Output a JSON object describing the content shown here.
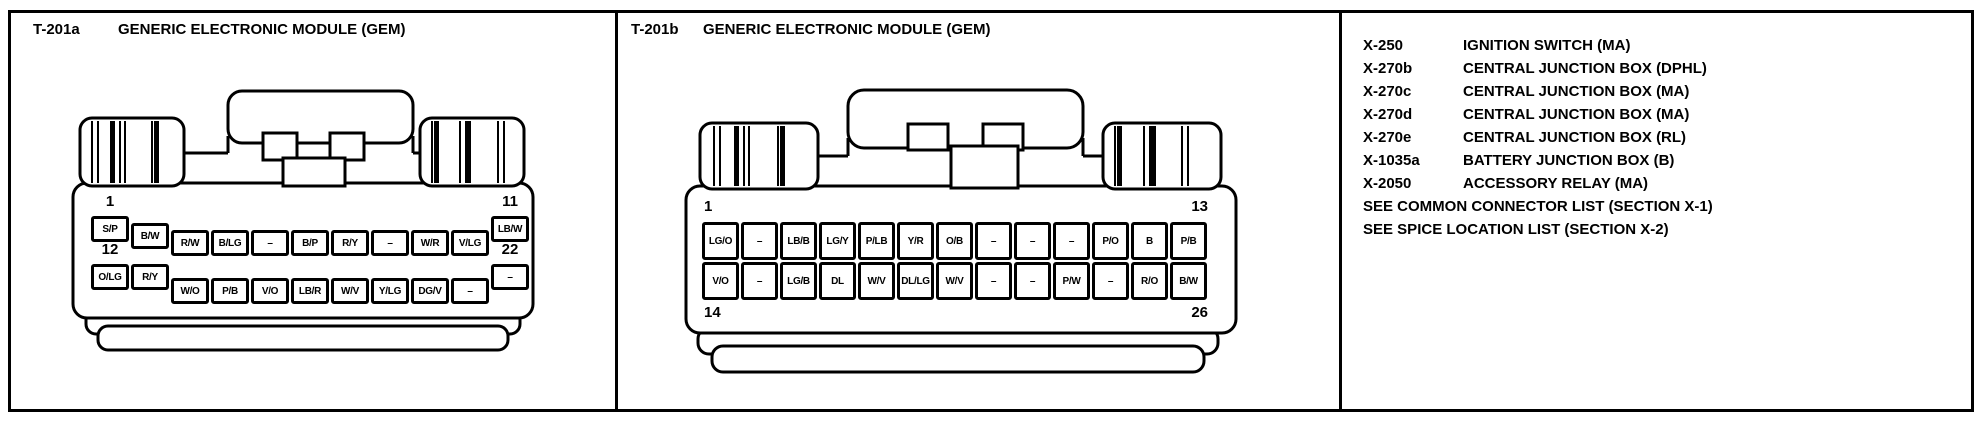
{
  "colors": {
    "ink": "#000000",
    "paper": "#ffffff"
  },
  "panels": {
    "t201a": {
      "code": "T-201a",
      "title": "GENERIC ELECTRONIC MODULE (GEM)",
      "connector": {
        "row1": {
          "start_pin": "1",
          "end_pin": "11",
          "cells": [
            "S/P",
            "B/W",
            "R/W",
            "B/LG",
            "–",
            "B/P",
            "R/Y",
            "–",
            "W/R",
            "V/LG",
            "LB/W"
          ]
        },
        "row2": {
          "start_pin": "12",
          "end_pin": "22",
          "cells": [
            "O/LG",
            "R/Y",
            "W/O",
            "P/B",
            "V/O",
            "LB/R",
            "W/V",
            "Y/LG",
            "DG/V",
            "–",
            "–"
          ]
        }
      }
    },
    "t201b": {
      "code": "T-201b",
      "title": "GENERIC ELECTRONIC MODULE (GEM)",
      "connector": {
        "row1": {
          "start_pin": "1",
          "end_pin": "13",
          "cells": [
            "LG/O",
            "–",
            "LB/B",
            "LG/Y",
            "P/LB",
            "Y/R",
            "O/B",
            "–",
            "–",
            "–",
            "P/O",
            "B",
            "P/B"
          ]
        },
        "row2": {
          "start_pin": "14",
          "end_pin": "26",
          "cells": [
            "V/O",
            "–",
            "LG/B",
            "DL",
            "W/V",
            "DL/LG",
            "W/V",
            "–",
            "–",
            "P/W",
            "–",
            "R/O",
            "B/W"
          ]
        }
      }
    },
    "legend": {
      "entries": [
        {
          "code": "X-250",
          "label": "IGNITION SWITCH (MA)"
        },
        {
          "code": "X-270b",
          "label": "CENTRAL JUNCTION BOX (DPHL)"
        },
        {
          "code": "X-270c",
          "label": "CENTRAL JUNCTION BOX (MA)"
        },
        {
          "code": "X-270d",
          "label": "CENTRAL JUNCTION BOX (MA)"
        },
        {
          "code": "X-270e",
          "label": "CENTRAL JUNCTION BOX (RL)"
        },
        {
          "code": "X-1035a",
          "label": "BATTERY JUNCTION BOX (B)"
        },
        {
          "code": "X-2050",
          "label": "ACCESSORY RELAY (MA)"
        }
      ],
      "notes": [
        "SEE COMMON CONNECTOR LIST (SECTION X-1)",
        "SEE SPICE LOCATION LIST (SECTION X-2)"
      ]
    }
  }
}
